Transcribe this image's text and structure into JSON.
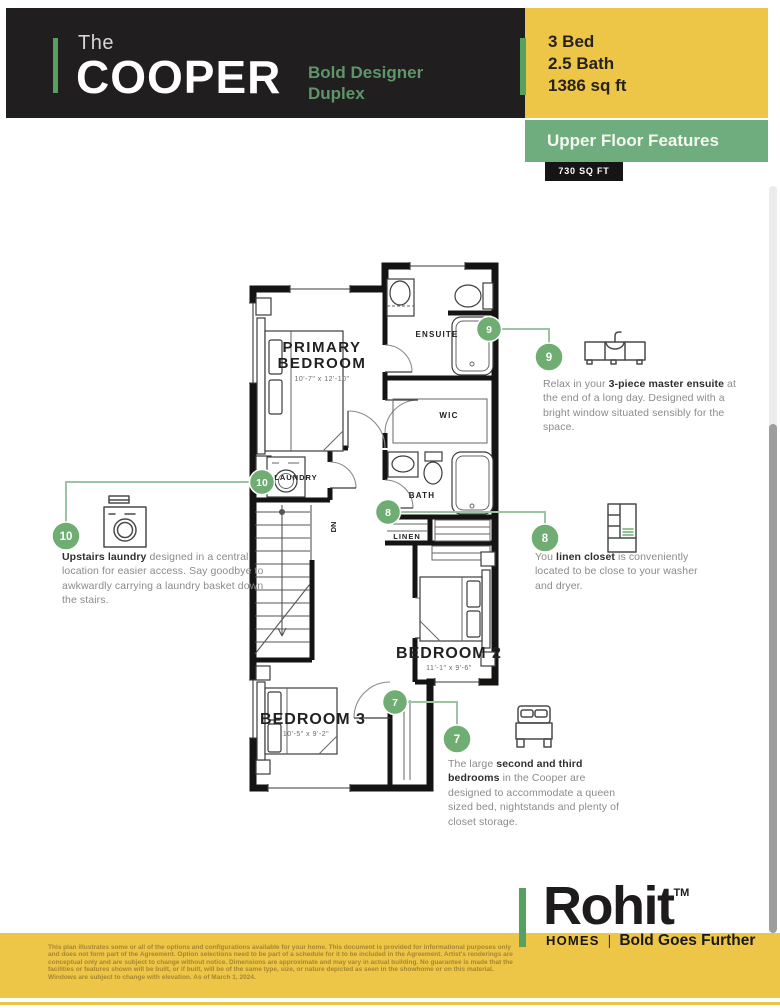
{
  "header": {
    "pre_title": "The",
    "title": "COOPER",
    "subtitle": "Bold Designer Duplex"
  },
  "specs": {
    "items": [
      "3 Bed",
      "2.5 Bath",
      "1386 sq ft"
    ]
  },
  "section": {
    "banner": "Upper Floor Features",
    "area_badge": "730 SQ FT"
  },
  "floorplan": {
    "rooms": {
      "primary": {
        "line1": "PRIMARY",
        "line2": "BEDROOM",
        "dims": "10'-7\" x 12'-10\""
      },
      "ensuite": {
        "label": "ENSUITE"
      },
      "wic": {
        "label": "WIC"
      },
      "laundry": {
        "label": "LAUNDRY"
      },
      "bath": {
        "label": "BATH"
      },
      "linen": {
        "label": "LINEN"
      },
      "bedroom2": {
        "label": "BEDROOM 2",
        "dims": "11'-1\" x 9'-6\""
      },
      "bedroom3": {
        "label": "BEDROOM 3",
        "dims": "10'-5\" x 9'-2\""
      },
      "stairs": {
        "label": "DN"
      }
    }
  },
  "annotations": [
    {
      "number": "9",
      "icon": "vanity-icon",
      "lead": "Relax in your ",
      "bold": "3-piece master ensuite",
      "rest": " at the end of a long day. Designed with a bright window situated sensibly for the space."
    },
    {
      "number": "8",
      "icon": "linen-closet-icon",
      "lead": "You ",
      "bold": "linen closet",
      "rest": " is conveniently located to be close to your washer and dryer."
    },
    {
      "number": "10",
      "icon": "washing-machine-icon",
      "lead": "",
      "bold": "Upstairs laundry",
      "rest": " designed in a central location for easier access. Say goodbye to awkwardly carrying a laundry basket down the stairs."
    },
    {
      "number": "7",
      "icon": "bed-icon",
      "lead": "The large ",
      "bold": "second and third bedrooms",
      "rest": " in the Cooper are designed to accommodate a queen sized bed, nightstands and plenty of closet storage."
    }
  ],
  "footer": {
    "brand": "Rohit",
    "trademark": "TM",
    "homes": "HOMES",
    "divider": "|",
    "tagline": "Bold Goes Further"
  },
  "disclaimer": "This plan illustrates some or all of the options and configurations available for your home. This document is provided for informational purposes only and does not form part of the Agreement. Option selections need to be part of a schedule for it to be included in the Agreement. Artist's renderings are conceptual only and are subject to change without notice. Dimensions are approximate and may vary in actual building. No guarantee is made that the facilities or features shown will be built, or if built, will be of the same type, size, or nature depicted as seen in the showhome or on this material. Windows are subject to change with elevation. As of March 1, 2024.",
  "colors": {
    "header_bg": "#211E1F",
    "brand_yellow": "#EDC648",
    "accent_green": "#56A15F",
    "banner_green": "#6FAD7E",
    "marker_green": "#6FAD72",
    "connector_green": "#9CC4A2",
    "body_text_gray": "#8B8B8B",
    "bold_text_dark": "#2F2F2F"
  }
}
